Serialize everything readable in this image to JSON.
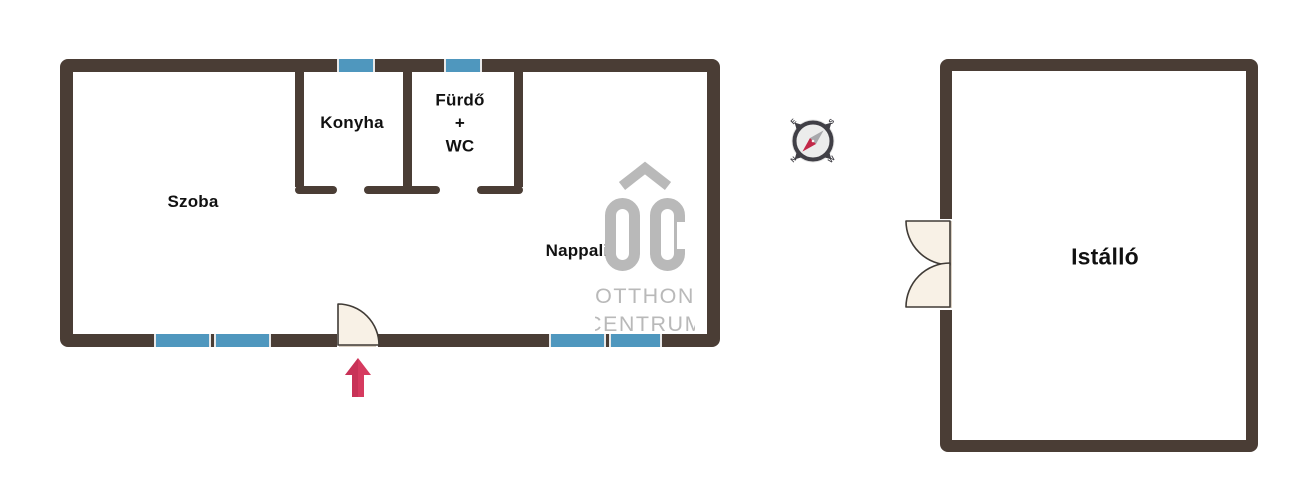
{
  "colors": {
    "wall": "#4a3d35",
    "window": "#4f97be",
    "window-edge": "#e9e9e9",
    "door-fill": "#f8f1e6",
    "door-stroke": "#403b36",
    "threshold": "#d9cfc2",
    "arrow": "#d63a5f",
    "arrow-dark": "#bd2c50",
    "logo-gray": "#b9b9b9",
    "compass-dark": "#403f46",
    "compass-face": "#ececec",
    "compass-halo": "#e3e3e3",
    "needle-gray": "#a8a8ac",
    "needle-red": "#c22849",
    "label": "#111111"
  },
  "rooms": {
    "szoba": "Szoba",
    "konyha": "Konyha",
    "furdo_line1": "Fürdő",
    "furdo_line2": "+",
    "furdo_line3": "WC",
    "nappali": "Nappali",
    "istallo": "Istálló"
  },
  "watermark": {
    "monogram": "OC",
    "line1": "OTTHON",
    "line2": "CENTRUM"
  },
  "compass": {
    "north": "N",
    "south": "S",
    "east": "E",
    "west": "W"
  }
}
